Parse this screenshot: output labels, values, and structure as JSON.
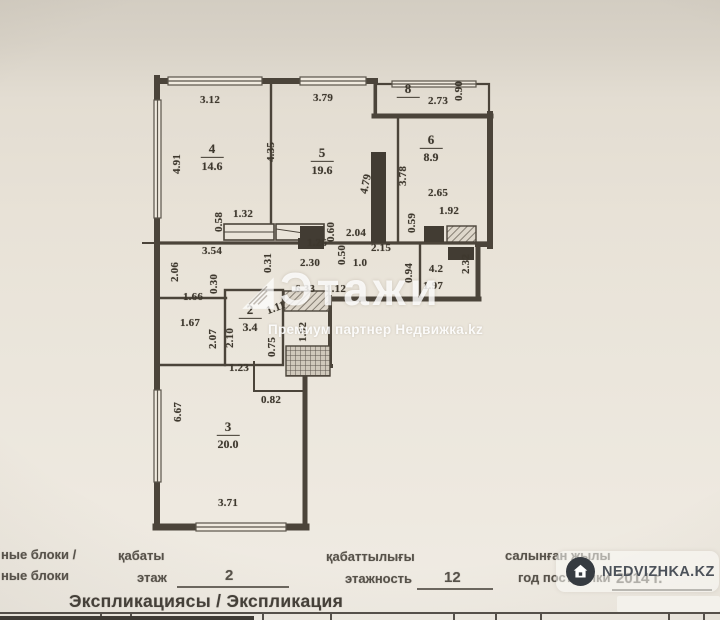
{
  "plan": {
    "rooms": [
      {
        "number": "4",
        "area": "14.6",
        "x": 212,
        "y": 158
      },
      {
        "number": "5",
        "area": "19.6",
        "x": 322,
        "y": 162
      },
      {
        "number": "6",
        "area": "8.9",
        "x": 431,
        "y": 149
      },
      {
        "number": "8",
        "area": "",
        "x": 408,
        "y": 90
      },
      {
        "number": "2",
        "area": "3.4",
        "x": 250,
        "y": 319
      },
      {
        "number": "3",
        "area": "20.0",
        "x": 228,
        "y": 436
      }
    ],
    "dimensions": [
      {
        "t": "3.12",
        "x": 210,
        "y": 100,
        "r": 0
      },
      {
        "t": "3.79",
        "x": 323,
        "y": 98,
        "r": 0
      },
      {
        "t": "2.73",
        "x": 438,
        "y": 101,
        "r": 0
      },
      {
        "t": "0.90",
        "x": 459,
        "y": 91,
        "r": -90
      },
      {
        "t": "4.91",
        "x": 177,
        "y": 164,
        "r": -90
      },
      {
        "t": "4.35",
        "x": 271,
        "y": 152,
        "r": -90
      },
      {
        "t": "4.79",
        "x": 366,
        "y": 184,
        "r": -78
      },
      {
        "t": "3.78",
        "x": 403,
        "y": 176,
        "r": -90
      },
      {
        "t": "2.65",
        "x": 438,
        "y": 193,
        "r": 0
      },
      {
        "t": "1.92",
        "x": 449,
        "y": 211,
        "r": 0
      },
      {
        "t": "0.59",
        "x": 412,
        "y": 223,
        "r": -90
      },
      {
        "t": "0.58",
        "x": 219,
        "y": 222,
        "r": -90
      },
      {
        "t": "1.32",
        "x": 243,
        "y": 214,
        "r": 0
      },
      {
        "t": "3.54",
        "x": 212,
        "y": 251,
        "r": 0
      },
      {
        "t": "2.06",
        "x": 175,
        "y": 272,
        "r": -90
      },
      {
        "t": "1.26",
        "x": 317,
        "y": 243,
        "r": 0
      },
      {
        "t": "2.30",
        "x": 310,
        "y": 263,
        "r": 0
      },
      {
        "t": "0.31",
        "x": 268,
        "y": 263,
        "r": -90
      },
      {
        "t": "0.60",
        "x": 331,
        "y": 232,
        "r": -90
      },
      {
        "t": "0.50",
        "x": 342,
        "y": 255,
        "r": -90
      },
      {
        "t": "1.0",
        "x": 360,
        "y": 263,
        "r": 0
      },
      {
        "t": "2.04",
        "x": 356,
        "y": 233,
        "r": 0
      },
      {
        "t": "2.15",
        "x": 381,
        "y": 248,
        "r": 0
      },
      {
        "t": "0.94",
        "x": 409,
        "y": 273,
        "r": -90
      },
      {
        "t": "4.2",
        "x": 436,
        "y": 269,
        "r": 0
      },
      {
        "t": "1.97",
        "x": 433,
        "y": 286,
        "r": 0
      },
      {
        "t": "2.32",
        "x": 466,
        "y": 264,
        "r": -90
      },
      {
        "t": "6.33",
        "x": 305,
        "y": 289,
        "r": 0
      },
      {
        "t": "1.12",
        "x": 336,
        "y": 289,
        "r": 0
      },
      {
        "t": "1.66",
        "x": 193,
        "y": 297,
        "r": 0
      },
      {
        "t": "0.30",
        "x": 214,
        "y": 284,
        "r": -90
      },
      {
        "t": "1.67",
        "x": 190,
        "y": 323,
        "r": 0
      },
      {
        "t": "2.07",
        "x": 213,
        "y": 339,
        "r": -90
      },
      {
        "t": "2.10",
        "x": 230,
        "y": 338,
        "r": -90
      },
      {
        "t": "1.11",
        "x": 276,
        "y": 308,
        "r": -20
      },
      {
        "t": "0.75",
        "x": 272,
        "y": 347,
        "r": -90
      },
      {
        "t": "1.92",
        "x": 303,
        "y": 332,
        "r": -90
      },
      {
        "t": "1.23",
        "x": 239,
        "y": 368,
        "r": 0
      },
      {
        "t": "0.82",
        "x": 271,
        "y": 400,
        "r": 0
      },
      {
        "t": "6.67",
        "x": 178,
        "y": 412,
        "r": -90
      },
      {
        "t": "3.71",
        "x": 228,
        "y": 503,
        "r": 0
      }
    ]
  },
  "watermark_center": {
    "logo_icon": "etazhi-house-logo-icon",
    "title": "Этажи",
    "subtitle": "Премиум партнер Недвижка.kz"
  },
  "watermark_badge": {
    "icon": "house-icon",
    "text": "NEDVIZHKA.KZ"
  },
  "footer": {
    "left_line1": "ные блоки /",
    "left_line2": "ные блоки",
    "floor_label_kz": "қабаты",
    "floor_label_ru": "этаж",
    "floor_value": "2",
    "floors_label_kz": "қабаттылығы",
    "floors_label_ru": "этажность",
    "floors_value": "12",
    "year_label_kz": "салынған жылы",
    "year_label_ru": "год постройки",
    "year_value": "2014 г.",
    "heading": "Экспликациясы / Экспликация"
  }
}
